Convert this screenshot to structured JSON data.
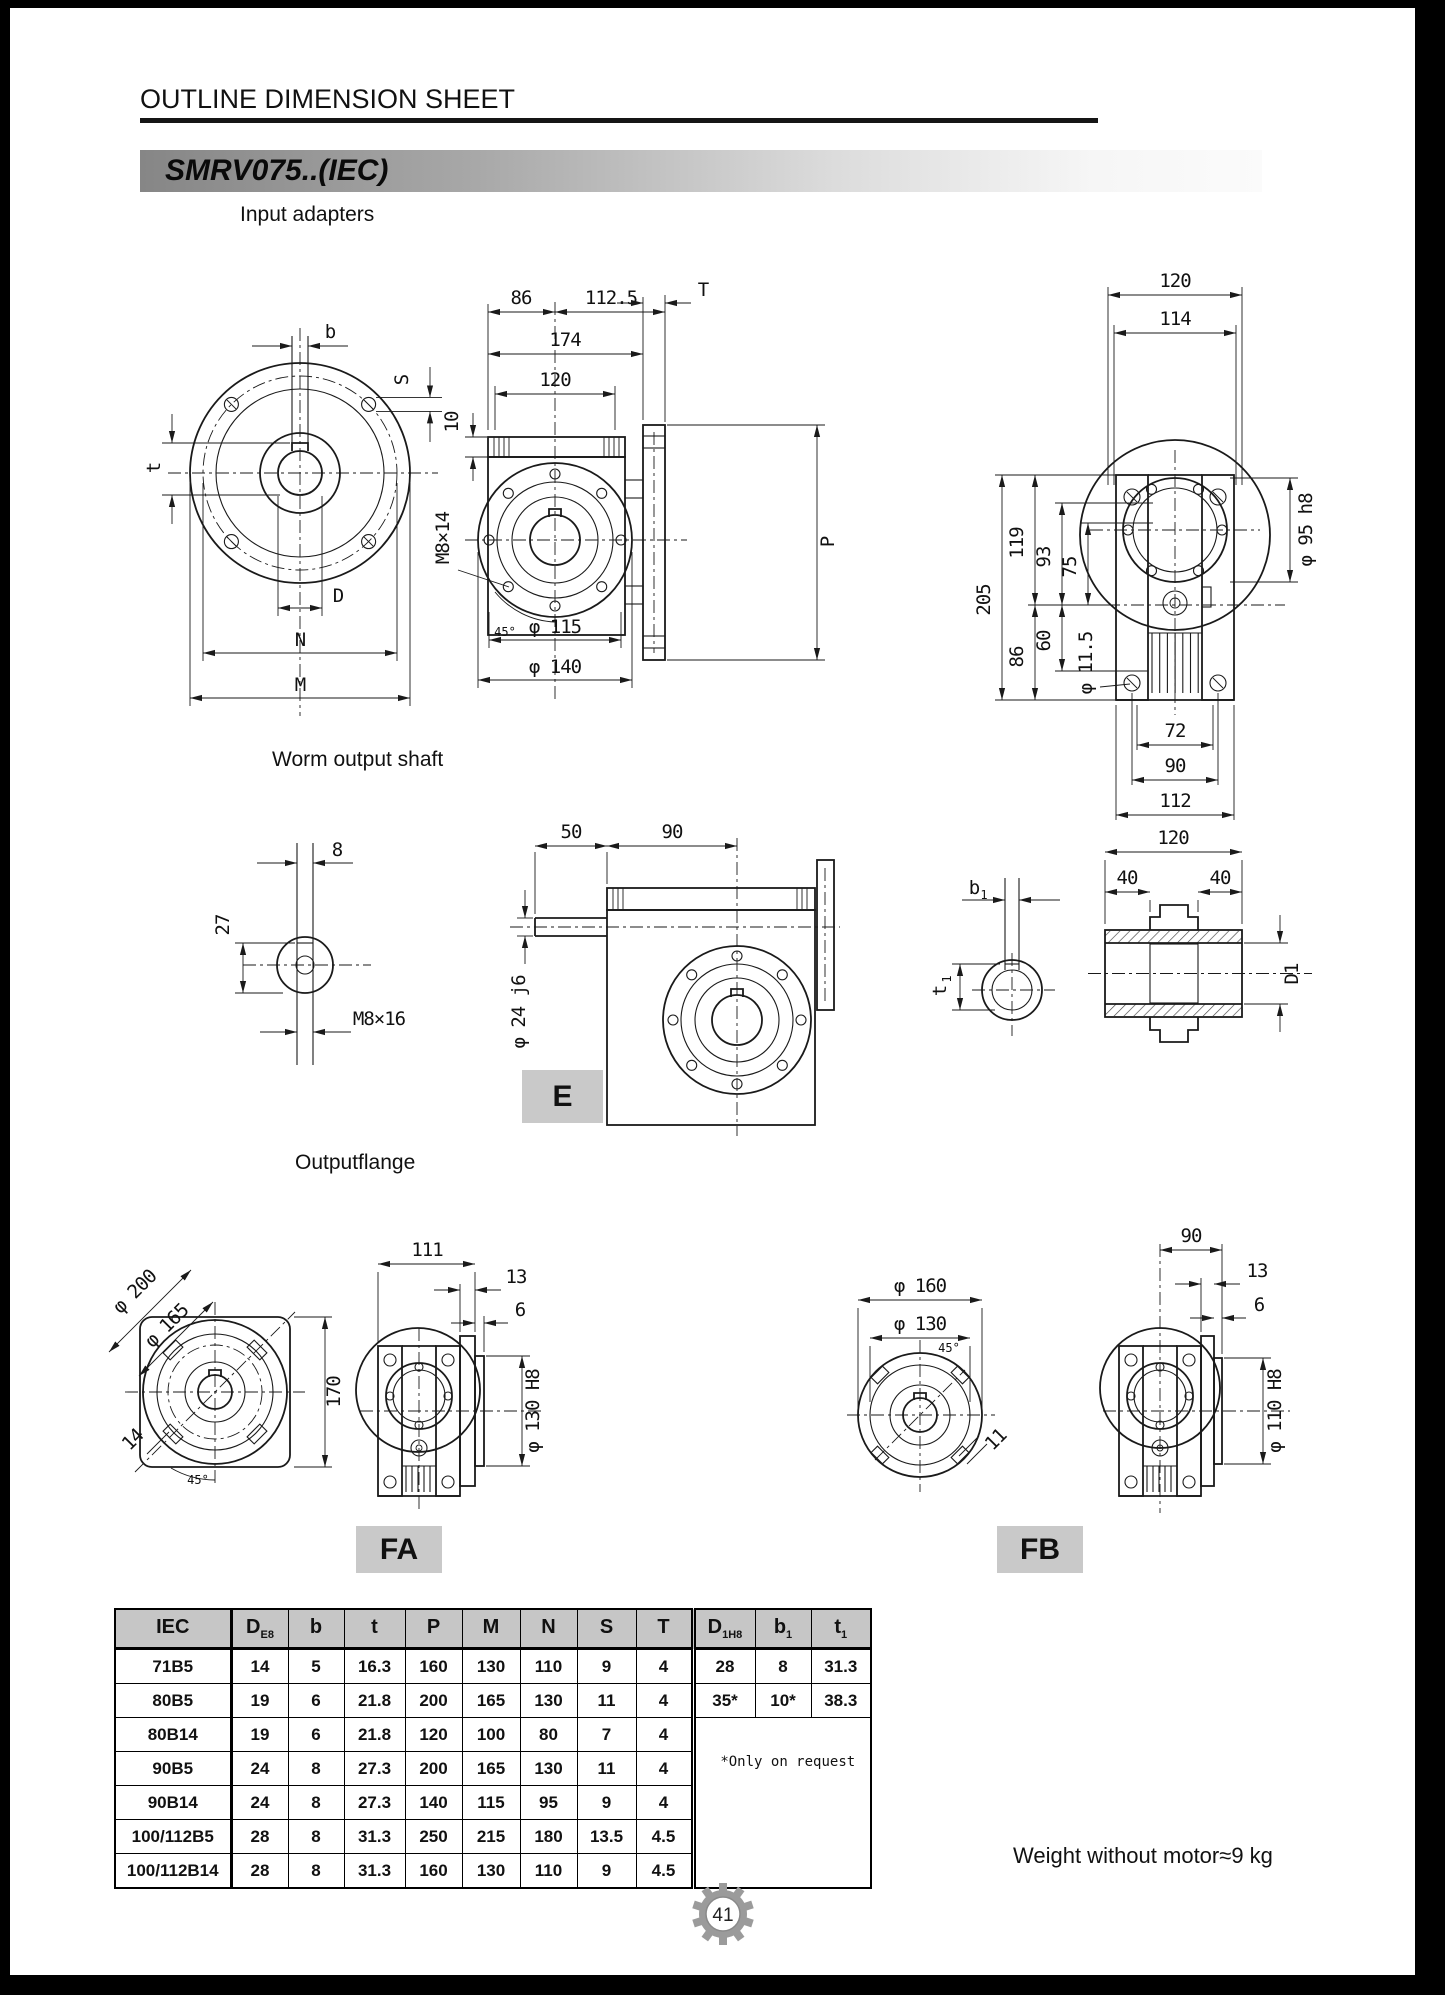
{
  "page": {
    "title": "OUTLINE DIMENSION SHEET",
    "model_badge": "SMRV075..(IEC)",
    "weight_note": "Weight without motor≈9 kg",
    "page_number": "41"
  },
  "sections": {
    "input_adapters": "Input adapters",
    "worm_output_shaft": "Worm output shaft",
    "outputflange": "Outputflange"
  },
  "view_labels": {
    "e": "E",
    "fa": "FA",
    "fb": "FB"
  },
  "dims": {
    "input_front": {
      "b": "b",
      "S": "S",
      "t": "t",
      "D": "D",
      "N": "N",
      "M": "M"
    },
    "input_side": {
      "top1a": "86",
      "top1b": "112.5",
      "top2": "174",
      "top3": "120",
      "left1": "10",
      "left2": "M8×14",
      "T": "T",
      "P": "P",
      "a45": "45°",
      "bot1": "φ 115",
      "bot2": "φ 140"
    },
    "input_rear": {
      "top1": "120",
      "top2": "114",
      "h205": "205",
      "h119": "119",
      "h93": "93",
      "h75": "75",
      "h60": "60",
      "h86": "86",
      "d95": "φ 95 h8",
      "d115": "φ 11.5",
      "b72": "72",
      "b90": "90",
      "b112": "112"
    },
    "shaft_end": {
      "w8": "8",
      "h27": "27",
      "thread": "M8×16"
    },
    "worm_side": {
      "l50": "50",
      "l90": "90",
      "d24": "φ 24 j6"
    },
    "bore_view": {
      "b1_main": "b",
      "b1_sub": "1",
      "t1_main": "t",
      "t1_sub": "1"
    },
    "hollow_shaft": {
      "l120": "120",
      "l40a": "40",
      "l40b": "40",
      "d1": "D1"
    },
    "fa_front": {
      "d200": "φ 200",
      "d165": "φ 165",
      "h170": "170",
      "s14": "14",
      "a45": "45°"
    },
    "fa_side": {
      "w111": "111",
      "t13": "13",
      "t6": "6",
      "d130": "φ 130  H8"
    },
    "fb_front": {
      "d160": "φ 160",
      "d130": "φ 130",
      "a45": "45°",
      "s11": "11"
    },
    "fb_side": {
      "w90": "90",
      "t13": "13",
      "t6": "6",
      "d110": "φ 110  H8"
    }
  },
  "table": {
    "headers_main": [
      {
        "main": "IEC",
        "sub": ""
      },
      {
        "main": "D",
        "sub": "E8"
      },
      {
        "main": "b",
        "sub": ""
      },
      {
        "main": "t",
        "sub": ""
      },
      {
        "main": "P",
        "sub": ""
      },
      {
        "main": "M",
        "sub": ""
      },
      {
        "main": "N",
        "sub": ""
      },
      {
        "main": "S",
        "sub": ""
      },
      {
        "main": "T",
        "sub": ""
      }
    ],
    "headers_extra": [
      {
        "main": "D",
        "sub": "1H8"
      },
      {
        "main": "b",
        "sub": "1"
      },
      {
        "main": "t",
        "sub": "1"
      }
    ],
    "rows": [
      {
        "iec": "71B5",
        "v": [
          "14",
          "5",
          "16.3",
          "160",
          "130",
          "110",
          "9",
          "4"
        ]
      },
      {
        "iec": "80B5",
        "v": [
          "19",
          "6",
          "21.8",
          "200",
          "165",
          "130",
          "11",
          "4"
        ]
      },
      {
        "iec": "80B14",
        "v": [
          "19",
          "6",
          "21.8",
          "120",
          "100",
          "80",
          "7",
          "4"
        ]
      },
      {
        "iec": "90B5",
        "v": [
          "24",
          "8",
          "27.3",
          "200",
          "165",
          "130",
          "11",
          "4"
        ]
      },
      {
        "iec": "90B14",
        "v": [
          "24",
          "8",
          "27.3",
          "140",
          "115",
          "95",
          "9",
          "4"
        ]
      },
      {
        "iec": "100/112B5",
        "v": [
          "28",
          "8",
          "31.3",
          "250",
          "215",
          "180",
          "13.5",
          "4.5"
        ]
      },
      {
        "iec": "100/112B14",
        "v": [
          "28",
          "8",
          "31.3",
          "160",
          "130",
          "110",
          "9",
          "4.5"
        ]
      }
    ],
    "extra_rows": [
      [
        "28",
        "8",
        "31.3"
      ],
      [
        "35*",
        "10*",
        "38.3"
      ]
    ],
    "note": "*Only on request"
  }
}
